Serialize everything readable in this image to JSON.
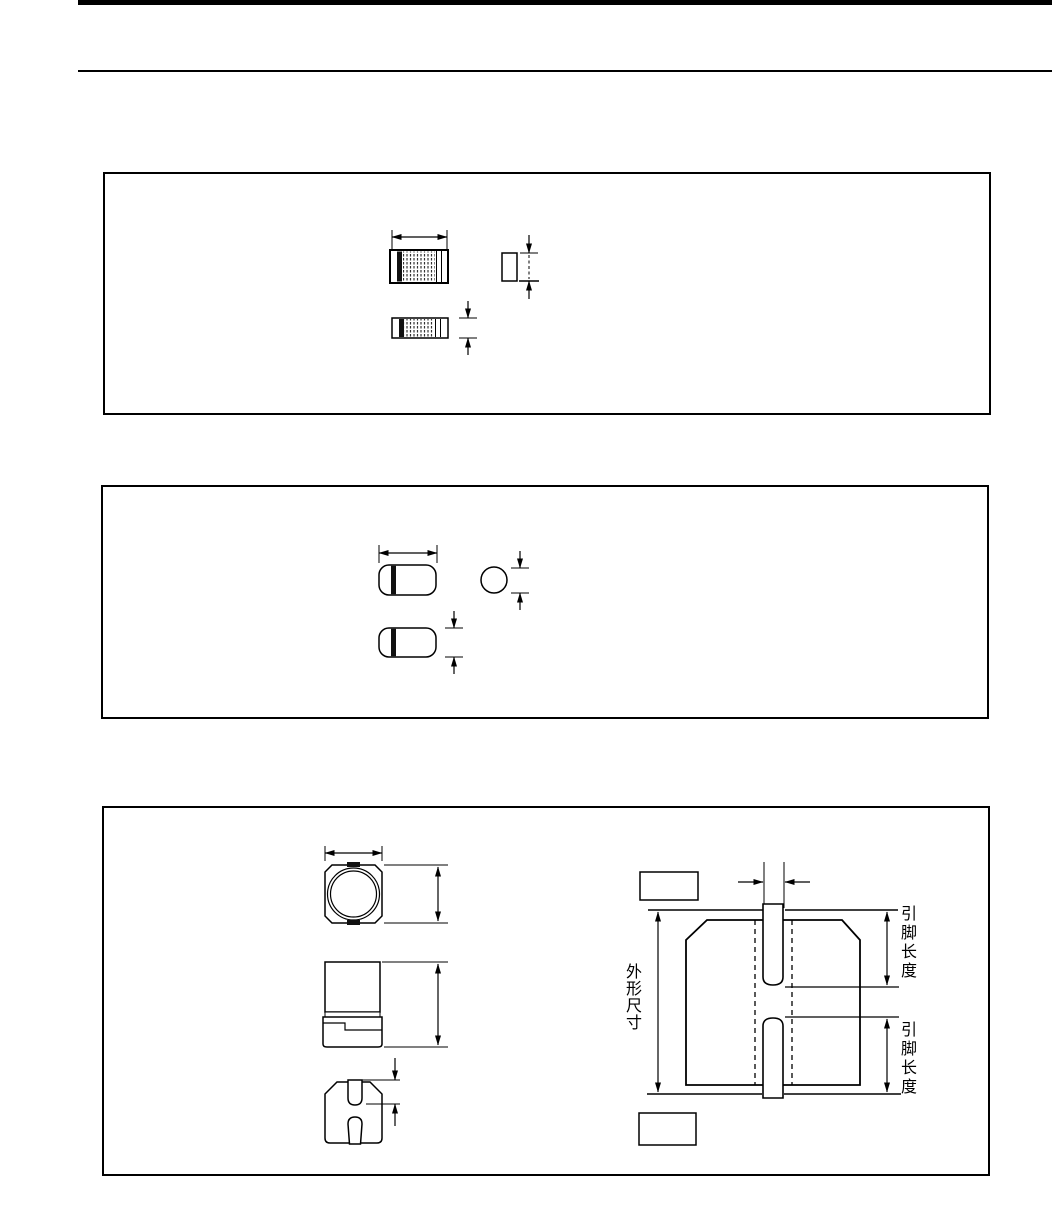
{
  "document": {
    "paper_color": "#ffffff",
    "ink_color": "#000000",
    "labels": {
      "outline_dimension": "外形尺寸",
      "lead_length_top": "引脚长度",
      "lead_length_bottom": "引脚长度"
    }
  }
}
